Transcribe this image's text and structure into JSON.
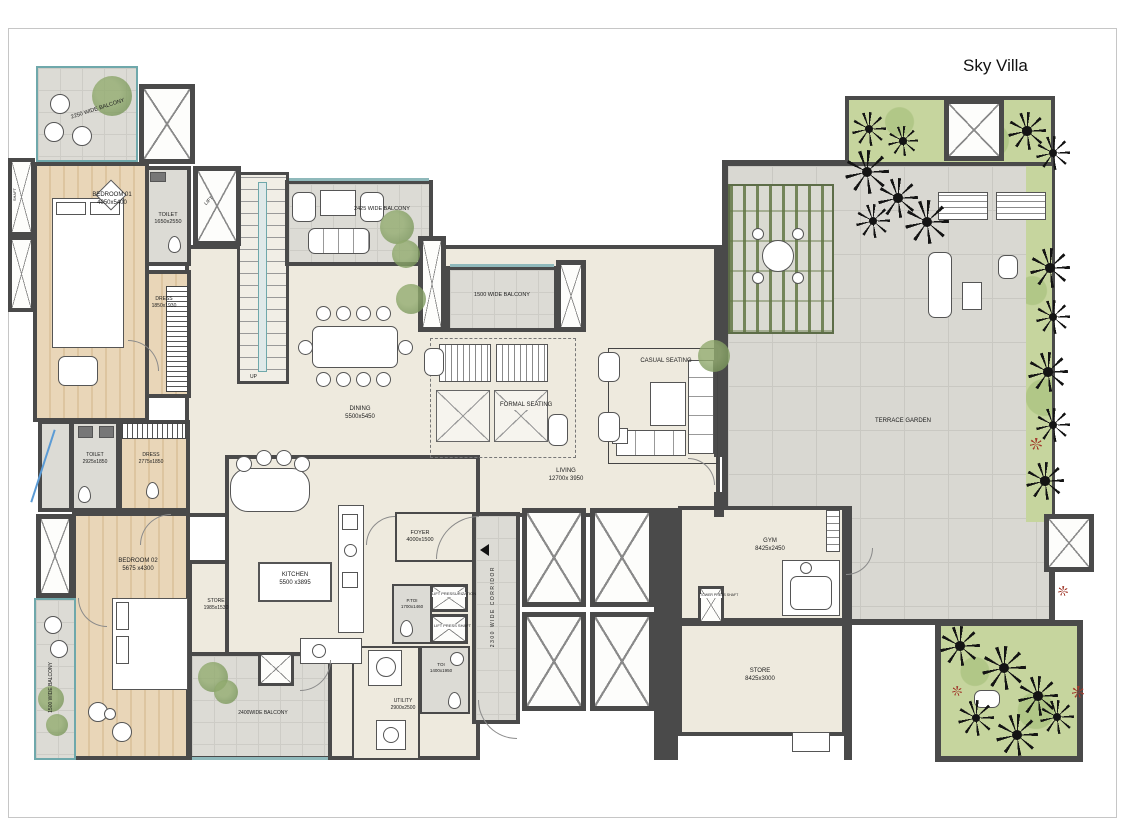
{
  "title": "Sky Villa",
  "rooms": {
    "bedroom01": {
      "name": "BEDROOM 01",
      "dims": "4050x5400"
    },
    "toilet01": {
      "name": "TOILET",
      "dims": "1650x2550"
    },
    "dress01": {
      "name": "DRESS",
      "dims": "1850x1930"
    },
    "toilet02": {
      "name": "TOILET",
      "dims": "2925x1850"
    },
    "dress02": {
      "name": "DRESS",
      "dims": "2775x1850"
    },
    "bedroom02": {
      "name": "BEDROOM 02",
      "dims": "5675 x4300"
    },
    "store01": {
      "name": "STORE",
      "dims": "1985x1530"
    },
    "kitchen": {
      "name": "KITCHEN",
      "dims": "5500 x3895"
    },
    "dining": {
      "name": "DINING",
      "dims": "5500x5450"
    },
    "living": {
      "name": "LIVING",
      "dims": "12700x 3950"
    },
    "formal": {
      "name": "FORMAL SEATING"
    },
    "casual": {
      "name": "CASUAL SEATING"
    },
    "foyer": {
      "name": "FOYER",
      "dims": "4000x1500"
    },
    "ptoi": {
      "name": "P.TOI",
      "dims": "1700x1460"
    },
    "toi": {
      "name": "TOI",
      "dims": "1400x1950"
    },
    "utility": {
      "name": "UTILITY",
      "dims": "2900x2500"
    },
    "gym": {
      "name": "GYM",
      "dims": "8425x2450"
    },
    "store02": {
      "name": "STORE",
      "dims": "8425x3000"
    },
    "terrace": {
      "name": "TERRACE GARDEN"
    },
    "corridor": {
      "name": "2300 WIDE CORRIDOR"
    },
    "lift": {
      "name": "LIFT"
    },
    "up": {
      "name": "UP"
    },
    "shaft": {
      "name": "SHAFT"
    },
    "liftPress": {
      "name": "LIFT PRESSURIZATION"
    },
    "lobbyPress": {
      "name": "LIFT PRESS SHAFT"
    },
    "towerPress": {
      "name": "TOWER PRESS SHAFT"
    }
  },
  "balconies": {
    "topLeft": "2250 WIDE BALCONY",
    "topMid": "2425 WIDE BALCONY",
    "topCenter": "1500 WIDE BALCONY",
    "left": "1500 WIDE BALCONY",
    "bottom": "2400WIDE BALCONY"
  },
  "colors": {
    "wall": "#4a4a4a",
    "accent_glass": "#6fa8ab",
    "floor_wood": "#e6d2b4",
    "floor_tile": "#d9d8d2",
    "garden_green": "#c6d59e"
  }
}
